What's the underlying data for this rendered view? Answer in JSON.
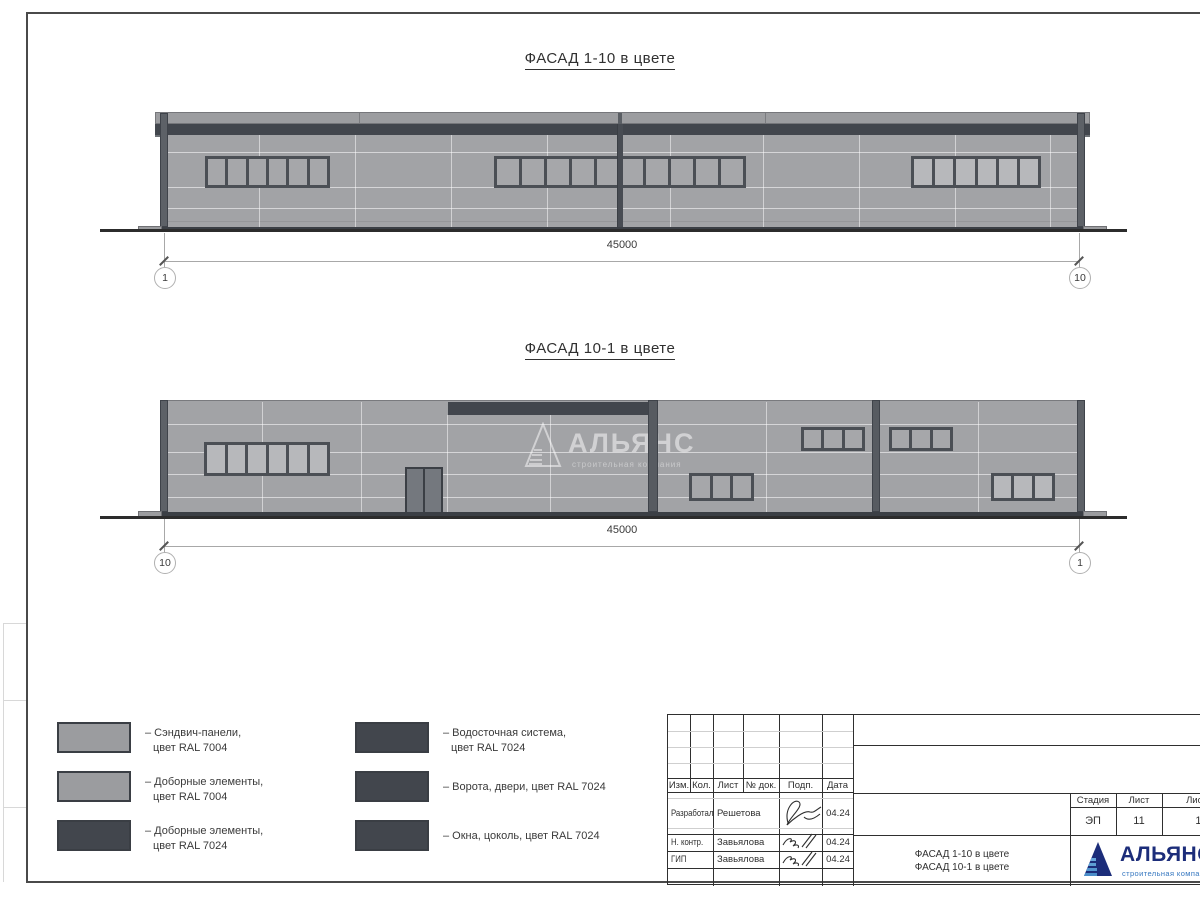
{
  "titles": {
    "facade1": "ФАСАД 1-10 в цвете",
    "facade2": "ФАСАД 10-1 в цвете"
  },
  "dimensions": {
    "facade1": {
      "value": "45000",
      "left_marker": "1",
      "right_marker": "10"
    },
    "facade2": {
      "value": "45000",
      "left_marker": "10",
      "right_marker": "1"
    }
  },
  "watermark": {
    "name": "АЛЬЯНС",
    "subtitle": "строительная компания"
  },
  "legend": {
    "items": [
      {
        "swatch": "#9b9c9f",
        "line1": "– Сэндвич-панели,",
        "line2": "цвет RAL 7004"
      },
      {
        "swatch": "#9b9c9f",
        "line1": "– Доборные элементы,",
        "line2": "цвет RAL 7004"
      },
      {
        "swatch": "#42464d",
        "line1": "– Доборные элементы,",
        "line2": "цвет RAL 7024"
      },
      {
        "swatch": "#42464d",
        "line1": "– Водосточная система,",
        "line2": "цвет RAL 7024"
      },
      {
        "swatch": "#42464d",
        "line1": "– Ворота, двери, цвет RAL 7024",
        "line2": ""
      },
      {
        "swatch": "#42464d",
        "line1": "– Окна, цоколь, цвет RAL 7024",
        "line2": ""
      }
    ]
  },
  "title_block": {
    "header_cols": [
      "Изм.",
      "Кол.",
      "Лист",
      "№ док.",
      "Подп.",
      "Дата"
    ],
    "rows": [
      {
        "role": "Разработал",
        "name": "Решетова",
        "date": "04.24"
      },
      {
        "role": "Н. контр.",
        "name": "Завьялова",
        "date": "04.24"
      },
      {
        "role": "ГИП",
        "name": "Завьялова",
        "date": "04.24"
      }
    ],
    "stage_cols": [
      "Стадия",
      "Лист",
      "Листов"
    ],
    "stage_values": [
      "ЭП",
      "11",
      "19"
    ],
    "sheet_name_line1": "ФАСАД 1-10 в цвете",
    "sheet_name_line2": "ФАСАД 10-1 в цвете",
    "logo": {
      "name": "АЛЬЯНС",
      "subtitle": "строительная компания"
    }
  },
  "colors": {
    "panel_gray_ral7004": "#9b9c9f",
    "dark_ral7024": "#42464d",
    "logo_navy": "#1c2d7a",
    "logo_blue": "#3577c0"
  }
}
